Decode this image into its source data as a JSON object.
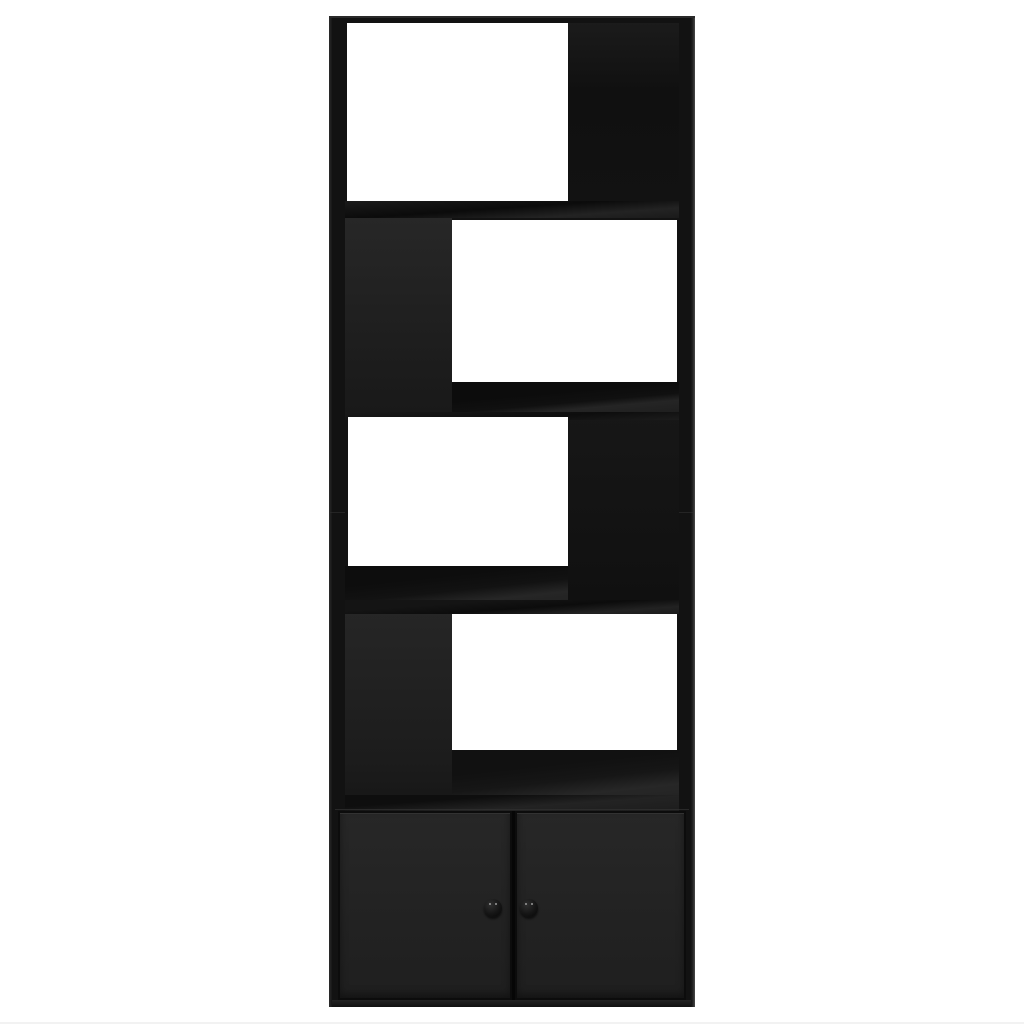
{
  "scene": {
    "type": "product-photo",
    "subject": "Black engineered-wood bookcase room divider with four open staggered compartments and a two-door base cabinet",
    "background_color": "#ffffff",
    "text_visible": "none"
  },
  "furniture": {
    "body_color": "#121212",
    "panel_color": "#232323",
    "opening_color": "#ffffff",
    "knob_color": "#1a1a1a",
    "knob_highlight_color": "#9a9a9a",
    "sections": [
      {
        "name": "compartment-1",
        "opening_side": "left",
        "back_panel_side": "right"
      },
      {
        "name": "compartment-2",
        "opening_side": "right",
        "back_panel_side": "left"
      },
      {
        "name": "compartment-3",
        "opening_side": "left",
        "back_panel_side": "right"
      },
      {
        "name": "compartment-4",
        "opening_side": "right",
        "back_panel_side": "left"
      },
      {
        "name": "base-cabinet",
        "doors": 2,
        "knobs": 2
      }
    ]
  }
}
